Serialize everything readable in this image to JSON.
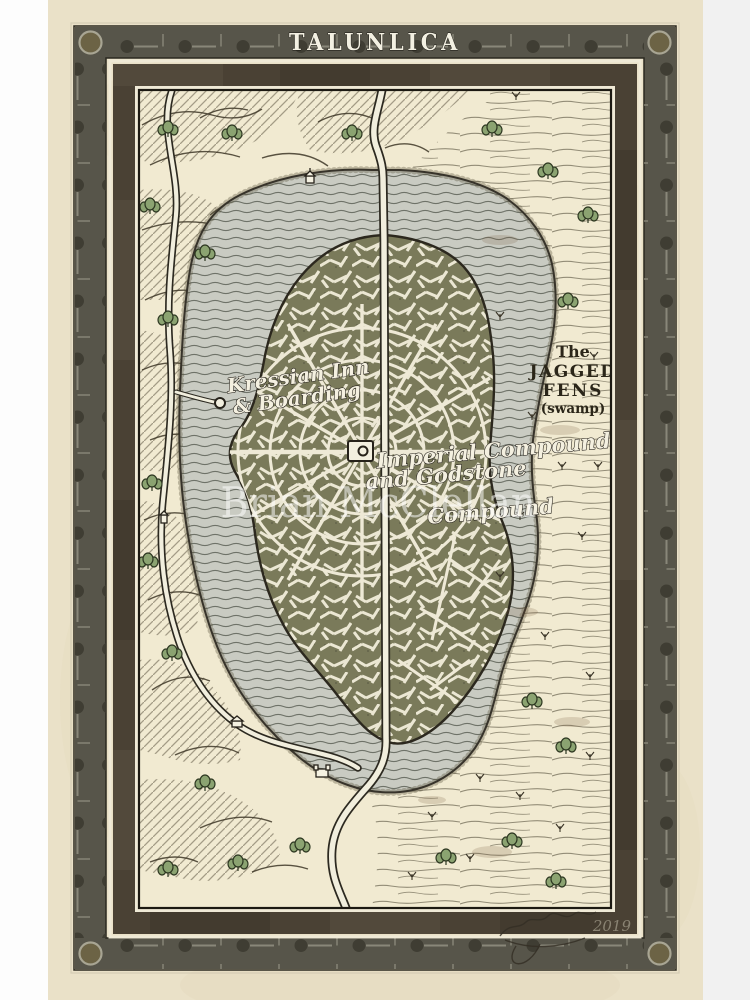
{
  "poster": {
    "title": "TALUNLICA",
    "watermark": "Brian McClellan",
    "signature_year": "2019"
  },
  "map_labels": {
    "kressian": {
      "line1": "Kressian Inn",
      "line2": "& Boarding"
    },
    "imperial": {
      "line1": "Imperial Compound",
      "line2": "and Godstone",
      "line3": "Compound"
    },
    "fens": {
      "line1": "The",
      "line2": "JAGGED",
      "line3": "FENS",
      "line4": "(swamp)"
    }
  },
  "colors": {
    "page_background": "#fdfdfd",
    "right_gutter": "#f1f1f1",
    "parchment": "#eae1c8",
    "map_parchment": "#f1ead1",
    "frame_band": "#57554a",
    "frame_mat": "#4a4134",
    "lake": "#c9cbc2",
    "city_blocks": "#7a7a5a",
    "road": "#f1eedd",
    "ink": "#2c281e",
    "tree_green": "#8ba371",
    "label_white": "#f4f0e0",
    "title_white": "#f3f0e2"
  }
}
